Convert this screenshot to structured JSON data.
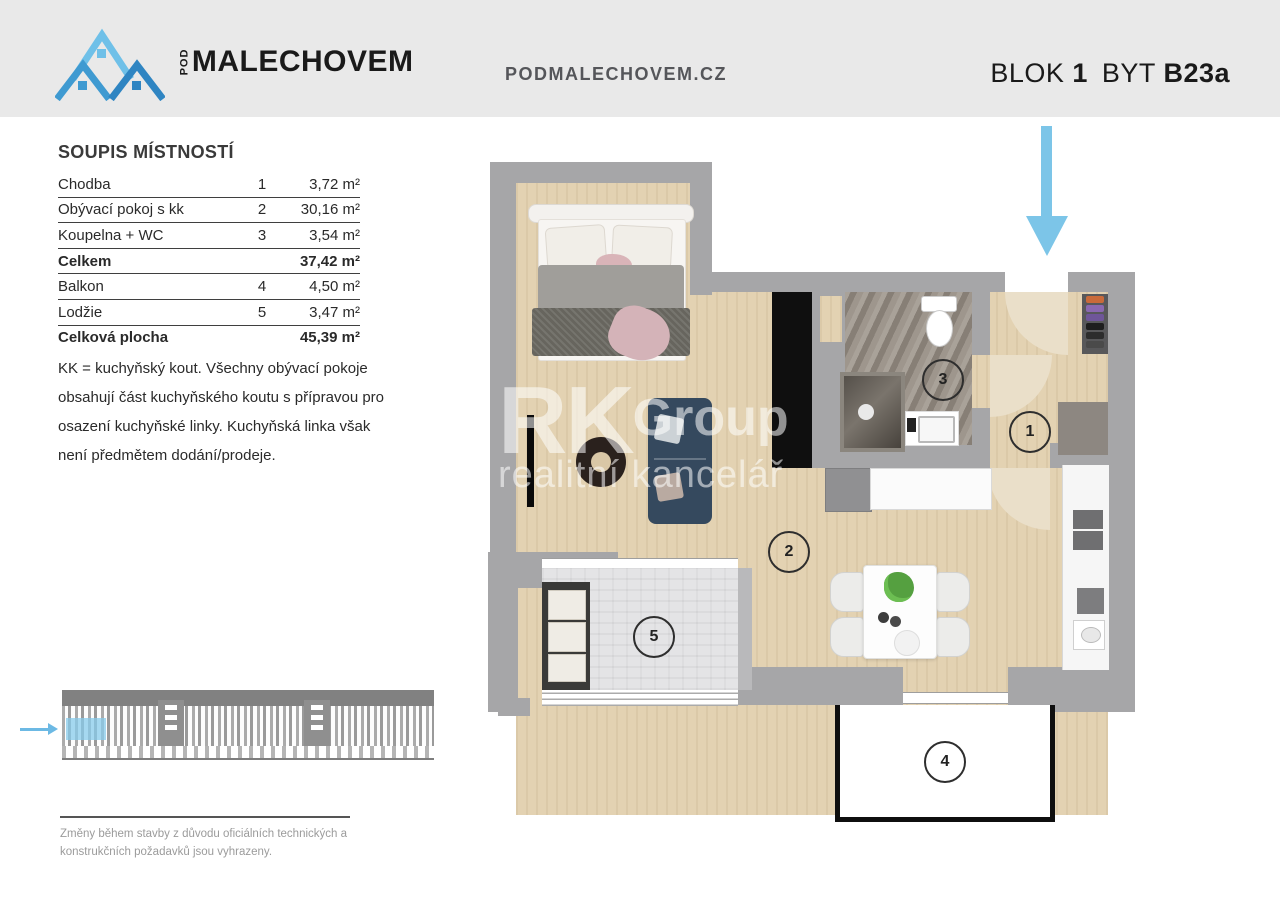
{
  "header": {
    "logo_pod": "POD",
    "logo_name": "MALECHOVEM",
    "website": "PODMALECHOVEM.CZ",
    "blok_label": "BLOK",
    "blok_value": "1",
    "byt_label": "BYT",
    "byt_value": "B23a"
  },
  "room_list": {
    "title": "SOUPIS MÍSTNOSTÍ",
    "rows": [
      {
        "name": "Chodba",
        "number": "1",
        "area": "3,72 m²"
      },
      {
        "name": "Obývací pokoj s kk",
        "number": "2",
        "area": "30,16 m²"
      },
      {
        "name": "Koupelna + WC",
        "number": "3",
        "area": "3,54 m²"
      },
      {
        "name": "Celkem",
        "number": "",
        "area": "37,42 m²"
      },
      {
        "name": "Balkon",
        "number": "4",
        "area": "4,50 m²"
      },
      {
        "name": "Lodžie",
        "number": "5",
        "area": "3,47 m²"
      },
      {
        "name": "Celková plocha",
        "number": "",
        "area": "45,39 m²"
      }
    ],
    "note": "KK = kuchyňský kout. Všechny obývací pokoje obsahují část kuchyňského koutu s přípravou pro osazení kuchyňské linky. Kuchyňská linka však není předmětem dodání/prodeje."
  },
  "floor_plan": {
    "room_numbers": [
      "1",
      "2",
      "3",
      "4",
      "5"
    ],
    "watermark": {
      "rk": "RK",
      "group": "Group",
      "sub": "realitní kancelář"
    }
  },
  "footer": {
    "disclaimer": "Změny během stavby z důvodu oficiálních technických a konstrukčních požadavků jsou vyhrazeny."
  },
  "colors": {
    "header_bg": "#e9e9e9",
    "logo_blue_light": "#6fc0e8",
    "logo_blue_dark": "#2f85c2",
    "wall_gray": "#a6a6a8",
    "wood": "#e3d2b2",
    "arrow_blue": "#7cc5e8",
    "highlight_blue": "#87cbeb"
  }
}
